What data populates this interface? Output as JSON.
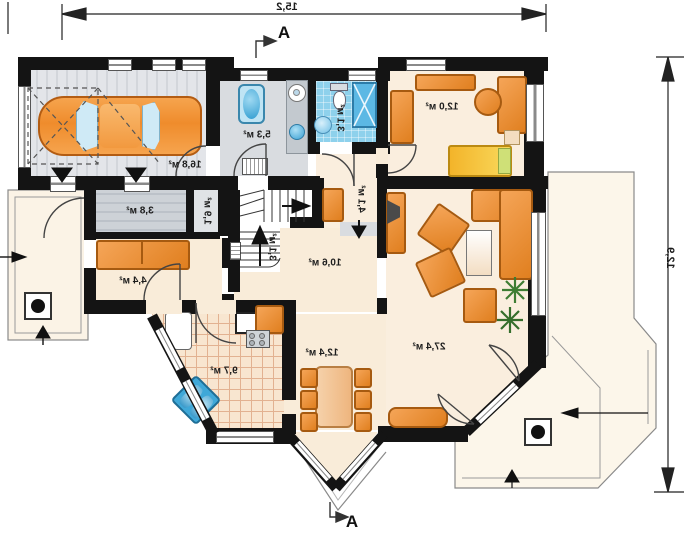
{
  "plan_title": "first-floor-plan",
  "dimensions": {
    "width": "15,2",
    "depth": "12,9"
  },
  "sections": {
    "top": "A",
    "bottom": "A"
  },
  "rooms": {
    "garage": {
      "area": "16,8 м²"
    },
    "utility": {
      "area": "5,3 м²"
    },
    "bathroom": {
      "area": "3,1 м²"
    },
    "bedroom": {
      "area": "12,0 м²"
    },
    "storage": {
      "area": "3,8 м²"
    },
    "closet": {
      "area": "1,9 м²"
    },
    "hallway": {
      "area": "4,4 м²"
    },
    "stairs": {
      "area": "3,1 м²"
    },
    "hall": {
      "area": "10,6 м²"
    },
    "corridor": {
      "area": "4,1 м²"
    },
    "kitchen": {
      "area": "9,7 м²"
    },
    "dining": {
      "area": "12,4 м²"
    },
    "living": {
      "area": "27,4 м²"
    }
  },
  "colors": {
    "walls": "#141414",
    "floor_cream": "#f9ecd9",
    "floor_gray": "#d9dce0",
    "tile_blue": "#8ed1ec",
    "furniture_orange": "#e98a2e",
    "water_blue": "#45aedd",
    "bed_yellow": "#f7cb3a",
    "plant_green": "#3e7d33"
  }
}
